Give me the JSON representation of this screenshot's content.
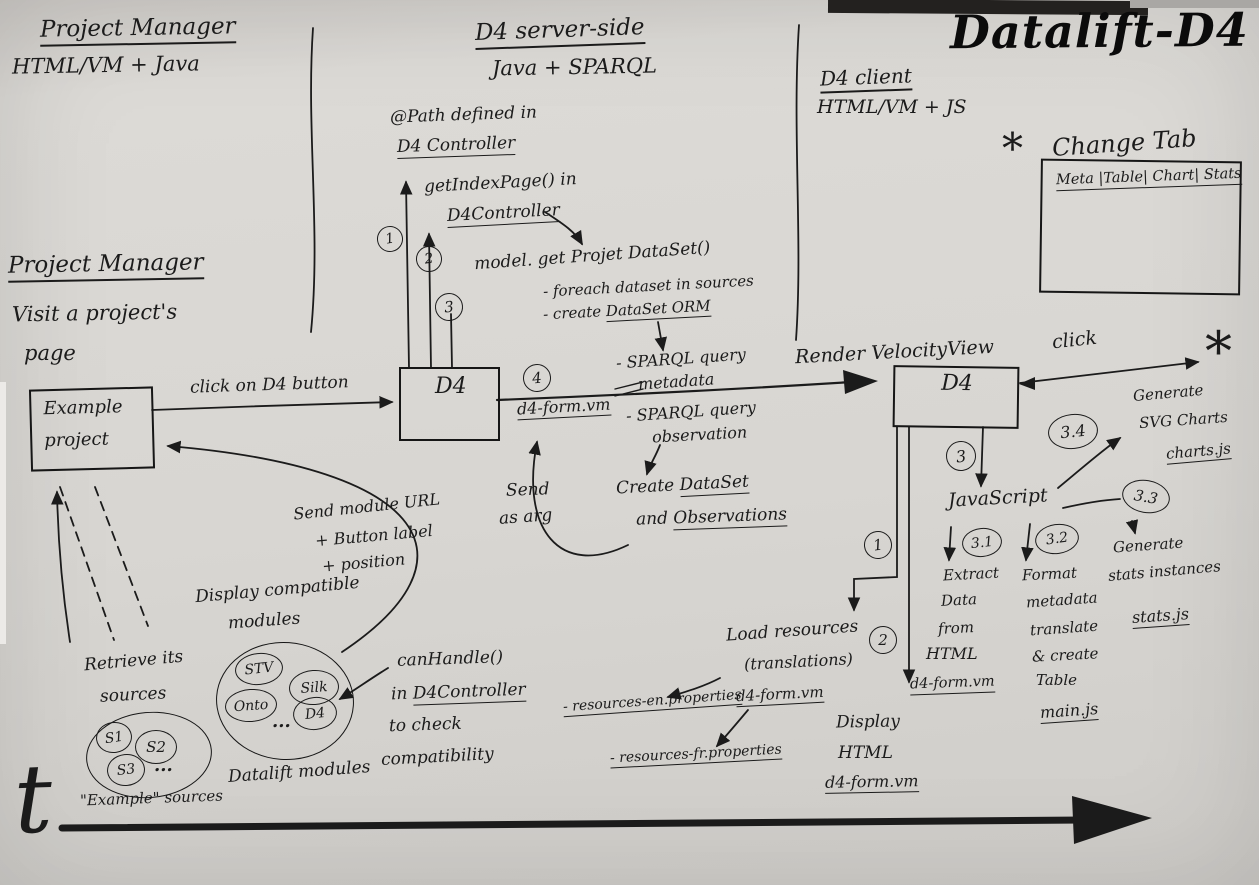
{
  "title": "Datalift-D4",
  "lanes": {
    "pm": {
      "heading": "Project Manager",
      "tech": "HTML/VM + Java"
    },
    "server": {
      "heading": "D4 server-side",
      "tech": "Java + SPARQL"
    },
    "client": {
      "heading": "D4 client",
      "tech": "HTML/VM + JS"
    }
  },
  "change_tab": {
    "star": "*",
    "label": "Change Tab",
    "tabs": "Meta |Table| Chart| Stats"
  },
  "pm_flow": {
    "heading": "Project Manager",
    "action_line1": "Visit a project's",
    "action_line2": "page",
    "node_line1": "Example",
    "node_line2": "project",
    "click_label": "click on D4 button",
    "retrieve_line1": "Retrieve its",
    "retrieve_line2": "sources",
    "sources": [
      "S1",
      "S2",
      "S3"
    ],
    "dots": "...",
    "caption": "\"Example\" sources"
  },
  "modules": {
    "note_line1": "Send module URL",
    "note_line2": "+ Button label",
    "note_line3": "+ position",
    "display_line1": "Display compatible",
    "display_line2": "modules",
    "items": [
      "STV",
      "Silk",
      "Onto",
      "D4"
    ],
    "dots": "...",
    "caption": "Datalift modules",
    "canhandle_line1": "canHandle()",
    "canhandle_line2_pre": "in ",
    "canhandle_line2_u": "D4Controller",
    "canhandle_line3": "to check",
    "canhandle_line4": "compatibility"
  },
  "server_flow": {
    "node": "D4",
    "step1": "1",
    "step2": "2",
    "step3": "3",
    "step4": "4",
    "path_line1": "@Path defined in",
    "path_line2": "D4 Controller",
    "getindex_line1": "getIndexPage() in",
    "getindex_line2": "D4Controller",
    "model_call": "model. get Projet DataSet()",
    "model_item1": "- foreach dataset in sources",
    "model_item2_pre": "- create ",
    "model_item2_u": "DataSet ORM",
    "sparql_meta_line1": "- SPARQL query",
    "sparql_meta_line2": "metadata",
    "sparql_obs_line1": "- SPARQL query",
    "sparql_obs_line2": "observation",
    "vm_file": "d4-form.vm",
    "send_line1": "Send",
    "send_line2": "as arg",
    "create_pre": "Create ",
    "create_u": "DataSet",
    "and_pre": "and ",
    "and_u": "Observations",
    "render_label": "Render VelocityView"
  },
  "client_flow": {
    "node": "D4",
    "click_label": "click",
    "star": "*",
    "step1": "1",
    "step2": "2",
    "step3": "3",
    "javascript": "JavaScript",
    "s31": {
      "num": "3.1",
      "l1": "Extract",
      "l2": "Data",
      "l3": "from",
      "l4": "HTML",
      "file": "d4-form.vm"
    },
    "s32": {
      "num": "3.2",
      "l1": "Format",
      "l2": "metadata",
      "l3": "translate",
      "l4": "& create",
      "l5": "Table",
      "file": "main.js"
    },
    "s33": {
      "num": "3.3",
      "l1": "Generate",
      "l2": "stats instances",
      "file": "stats.js"
    },
    "s34": {
      "num": "3.4",
      "l1": "Generate",
      "l2": "SVG Charts",
      "file": "charts.js"
    },
    "load_line1": "Load resources",
    "load_line2": "(translations)",
    "load_vm": "d4-form.vm",
    "res_en": "- resources-en.properties",
    "res_fr": "- resources-fr.properties",
    "display_line1": "Display",
    "display_line2": "HTML",
    "display_file": "d4-form.vm"
  },
  "timeline": {
    "label": "t"
  }
}
